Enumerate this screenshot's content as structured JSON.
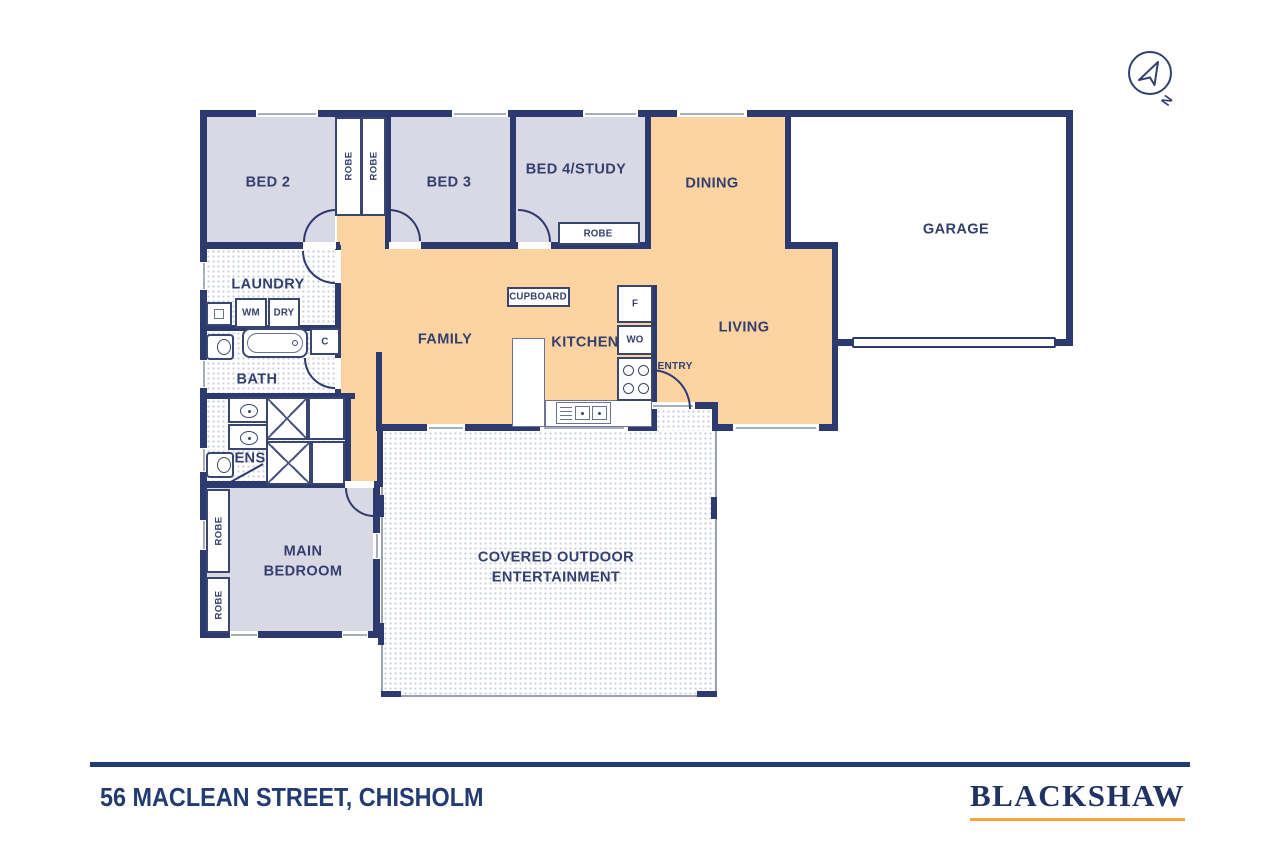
{
  "page": {
    "address": "56 MACLEAN STREET, CHISHOLM",
    "brand": "BLACKSHAW",
    "north": "N"
  },
  "colors": {
    "wall": "#2c3a70",
    "label_text": "#33406e",
    "floor_orange": "#fcd3a1",
    "floor_lavender": "#d9d8e5",
    "tile_dot": "#c9cedb",
    "outdoor_border": "#9aa1b0",
    "brand_underline": "#f2a83d",
    "footer_line": "#223b72"
  },
  "rooms": {
    "bed2": "BED 2",
    "bed3": "BED 3",
    "bed4": "BED 4/STUDY",
    "dining": "DINING",
    "garage": "GARAGE",
    "laundry": "LAUNDRY",
    "bath": "BATH",
    "ens": "ENS",
    "family": "FAMILY",
    "kitchen": "KITCHEN",
    "living": "LIVING",
    "entry": "ENTRY",
    "main_bedroom": "MAIN BEDROOM",
    "outdoor": "COVERED OUTDOOR ENTERTAINMENT"
  },
  "fixtures": {
    "robe": "ROBE",
    "washing_machine": "WM",
    "dryer": "DRY",
    "linen_cupboard": "C",
    "fridge": "F",
    "wall_oven": "WO",
    "cupboard": "CUPBOARD"
  }
}
